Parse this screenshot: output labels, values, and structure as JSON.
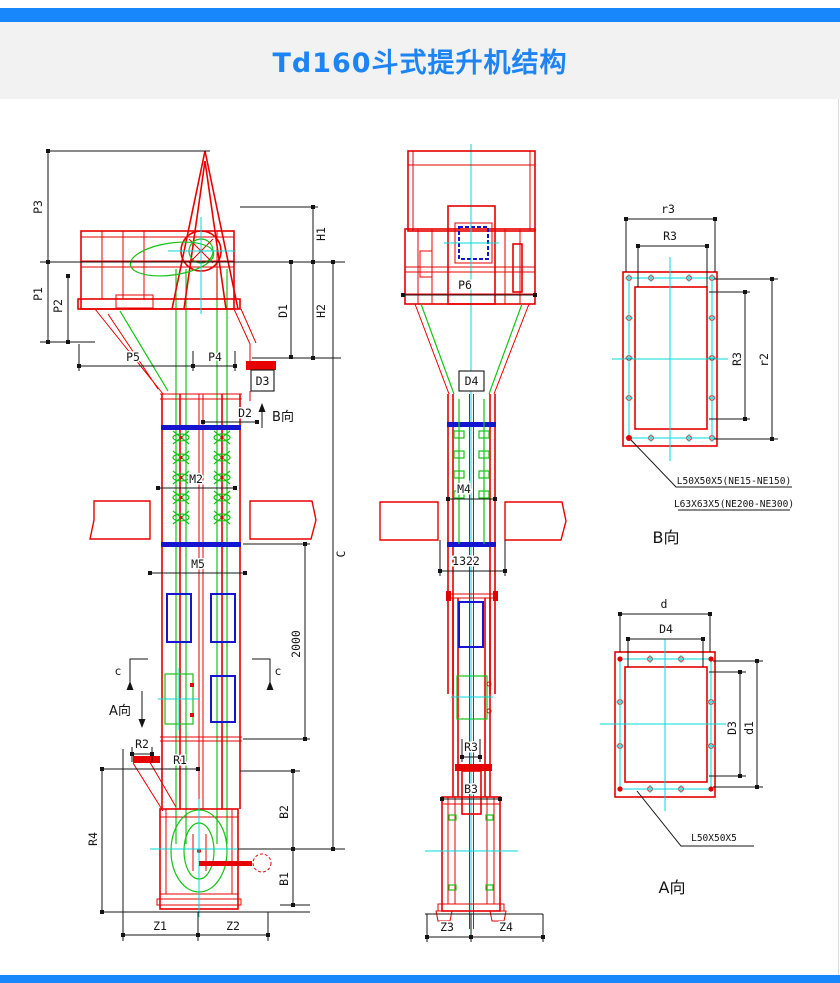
{
  "page": {
    "title": "Td160斗式提升机结构"
  },
  "colors": {
    "accent_blue": "#1787fb",
    "title_blue": "#1d84f5",
    "line_red": "#e80000",
    "line_green": "#15c315",
    "line_cyan": "#00d8d8",
    "line_blue": "#1515d0",
    "dim_black": "#141414"
  },
  "front_view": {
    "p3": "P3",
    "p1": "P1",
    "p2": "P2",
    "p5": "P5",
    "p4": "P4",
    "h1": "H1",
    "h2": "H2",
    "d1": "D1",
    "d2": "D2",
    "d3": "D3",
    "b_dir": "B向",
    "m2": "M2",
    "m5": "M5",
    "c_total": "C",
    "dim_2000": "2000",
    "c_sec_left": "c",
    "c_sec_right": "c",
    "a_dir": "A向",
    "r2": "R2",
    "r1": "R1",
    "r4": "R4",
    "b2": "B2",
    "b1": "B1",
    "z1": "Z1",
    "z2": "Z2"
  },
  "side_view": {
    "p6": "P6",
    "d4": "D4",
    "m4": "M4",
    "dim_1322": "1322",
    "r3": "R3",
    "b3": "B3",
    "z3": "Z3",
    "z4": "Z4"
  },
  "detail_b": {
    "dim_outer_width": "r3",
    "dim_inner_width": "R3",
    "dim_inner_height": "R3",
    "dim_outer_height": "r2",
    "note_line1": "L50X50X5(NE15-NE150)",
    "note_line2": "L63X63X5(NE200-NE300)",
    "caption": "B向"
  },
  "detail_a": {
    "dim_outer_width": "d",
    "dim_inner_width": "D4",
    "dim_inner_height": "D3",
    "dim_outer_height": "d1",
    "note": "L50X50X5",
    "caption": "A向"
  }
}
